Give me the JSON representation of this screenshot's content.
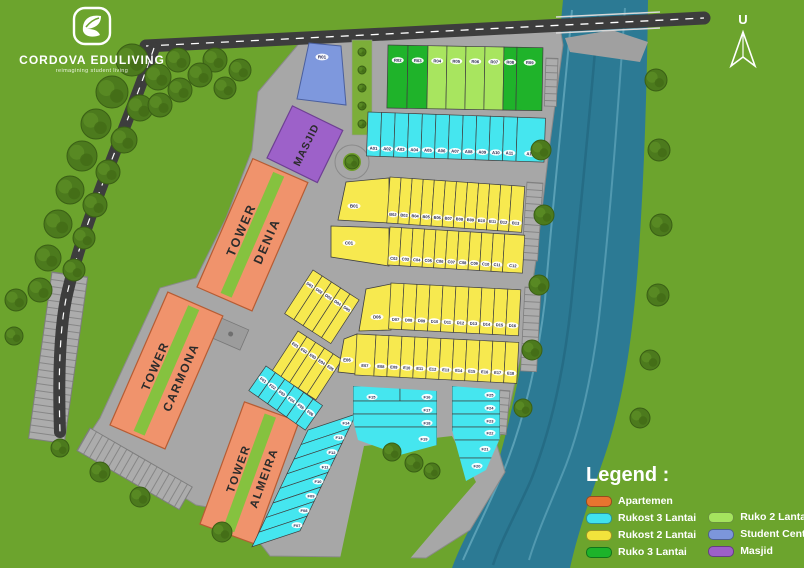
{
  "logo": {
    "name": "CORDOVA EDULIVING",
    "tagline": "reimagining student living"
  },
  "compass": {
    "label": "U"
  },
  "legend": {
    "title": "Legend :",
    "items": [
      {
        "label": "Apartemen",
        "color": "#E8742F"
      },
      {
        "label": "Rukost 3 Lantai",
        "color": "#40E2EE"
      },
      {
        "label": "Rukost 2 Lantai",
        "color": "#F2E33C"
      },
      {
        "label": "Ruko 3 Lantai",
        "color": "#1DB32A"
      },
      {
        "label": "Ruko 2 Lantai",
        "color": "#A5E45E"
      },
      {
        "label": "Student Center",
        "color": "#7C96DB"
      },
      {
        "label": "Masjid",
        "color": "#9D60C8"
      }
    ]
  },
  "map": {
    "towers": [
      {
        "line1": "TOWER",
        "line2": "DENIA"
      },
      {
        "line1": "TOWER",
        "line2": "CARMONA"
      },
      {
        "line1": "TOWER",
        "line2": "ALMEIRA"
      }
    ],
    "masjid_label": "MASJID",
    "units": {
      "student_center": "R01",
      "ruko": [
        {
          "label": "R02",
          "type": "ruko3"
        },
        {
          "label": "R03",
          "type": "ruko3"
        },
        {
          "label": "R04",
          "type": "ruko2"
        },
        {
          "label": "R05",
          "type": "ruko2"
        },
        {
          "label": "R06",
          "type": "ruko2"
        },
        {
          "label": "R07",
          "type": "ruko2"
        },
        {
          "label": "R08",
          "type": "ruko3"
        },
        {
          "label": "R09",
          "type": "ruko3"
        }
      ],
      "row_a": [
        "A01",
        "A02",
        "A03",
        "A04",
        "A05",
        "A06",
        "A07",
        "A08",
        "A09",
        "A10",
        "A11",
        "A12"
      ],
      "row_b": [
        "B01",
        "B02",
        "B03",
        "B04",
        "B05",
        "B06",
        "B07",
        "B08",
        "B09",
        "B10",
        "B11",
        "B12",
        "B13"
      ],
      "row_c": [
        "C01",
        "C02",
        "C03",
        "C04",
        "C05",
        "C06",
        "C07",
        "C08",
        "C09",
        "C10",
        "C11",
        "C12"
      ],
      "group_d": [
        "D01",
        "D02",
        "D03",
        "D04",
        "D05",
        "D06",
        "D07",
        "D08",
        "D09",
        "D10",
        "D11",
        "D12",
        "D13",
        "D14",
        "D15",
        "D16"
      ],
      "group_e": [
        "E01",
        "E02",
        "E03",
        "E04",
        "E05",
        "E06",
        "E07",
        "E08",
        "E09",
        "E10",
        "E11",
        "E12",
        "E13",
        "E14",
        "E15",
        "E16",
        "E17",
        "E18"
      ],
      "group_f": [
        "F01",
        "F02",
        "F03",
        "F04",
        "F05",
        "F06",
        "F07",
        "F08",
        "F09",
        "F10",
        "F11",
        "F12",
        "F13",
        "F14",
        "F15",
        "F16",
        "F17",
        "F18",
        "F19",
        "F20",
        "F21",
        "F22",
        "F23",
        "F24",
        "F25"
      ]
    },
    "colors": {
      "background": "#6CA42D",
      "pavement": "#A7A7A7",
      "road": "#3D3D3D",
      "river": "#2C7A94",
      "apartemen": "#F0936C",
      "rukost3": "#45E6EF",
      "rukost2": "#F7E94F",
      "ruko3": "#1FB32A",
      "ruko2": "#A8E55F",
      "student_center": "#7E98DD",
      "masjid": "#9D61C9",
      "tower_stripe": "#85C23F",
      "tree": "#4C7A1D"
    }
  }
}
